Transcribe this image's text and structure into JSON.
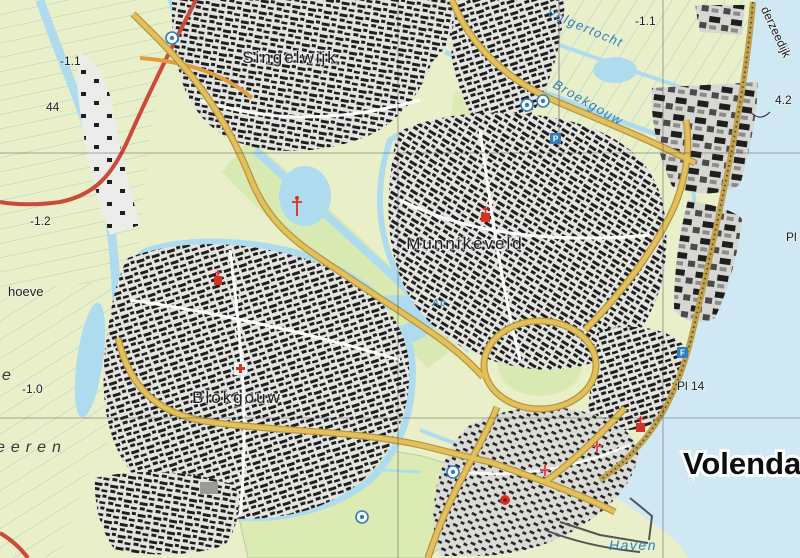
{
  "map": {
    "type": "topographic-map",
    "region_name": "Volendam",
    "labels": {
      "singelwijk": "Singelwijk",
      "volgertocht": "Volgertocht",
      "broekgouw": "Broekgouw",
      "munnikeveld": "Munnikeveld",
      "blokgouw": "Blokgouw",
      "volendam": "Volendam",
      "haven": "Haven",
      "derzeedijk": "derzeedijk",
      "hoeve_fragment": "hoeve",
      "e_fragment": "e",
      "eeren_fragment": "eeren",
      "ab": "Ab",
      "pl14": "Pl 14",
      "pl_fragment": "Pl",
      "elev_nw": "-1.1",
      "elev_ne": "-1.1",
      "elev_w": "-1.2",
      "elev_sw": "-1.0",
      "elev_dike": "4.2",
      "marker_44": "44"
    },
    "icon_glyphs": {
      "parking": "P",
      "facility": "F"
    },
    "icons": [
      "sports-hall-icon",
      "sports-hall-icon",
      "leisure-icon",
      "parking-icon",
      "facility-icon",
      "hospital-cross-icon",
      "church-icon",
      "church-icon",
      "church-icon",
      "monument-icon",
      "mast-icon",
      "sports-field-icon",
      "sports-field-icon"
    ],
    "colors": {
      "polder": "#e9efc9",
      "parcel_line": "#9fd0cf",
      "water": "#aedcee",
      "sea": "#cfe8f3",
      "urban": "#e4e4e1",
      "urban_dark": "#d6d6d3",
      "building": "#1f1f1f",
      "park": "#d8e9b2",
      "road_main": "#e3c05c",
      "road_casing": "#b3963c",
      "road_orange": "#e09c40",
      "motorway": "#cc4a3a",
      "dike": "#c2a14e",
      "label_black": "#1d1d1d",
      "label_water": "#2d7fc0",
      "symbol_red": "#d93025",
      "symbol_blue": "#2d7fc0",
      "grid": "#3c3c3c"
    }
  }
}
